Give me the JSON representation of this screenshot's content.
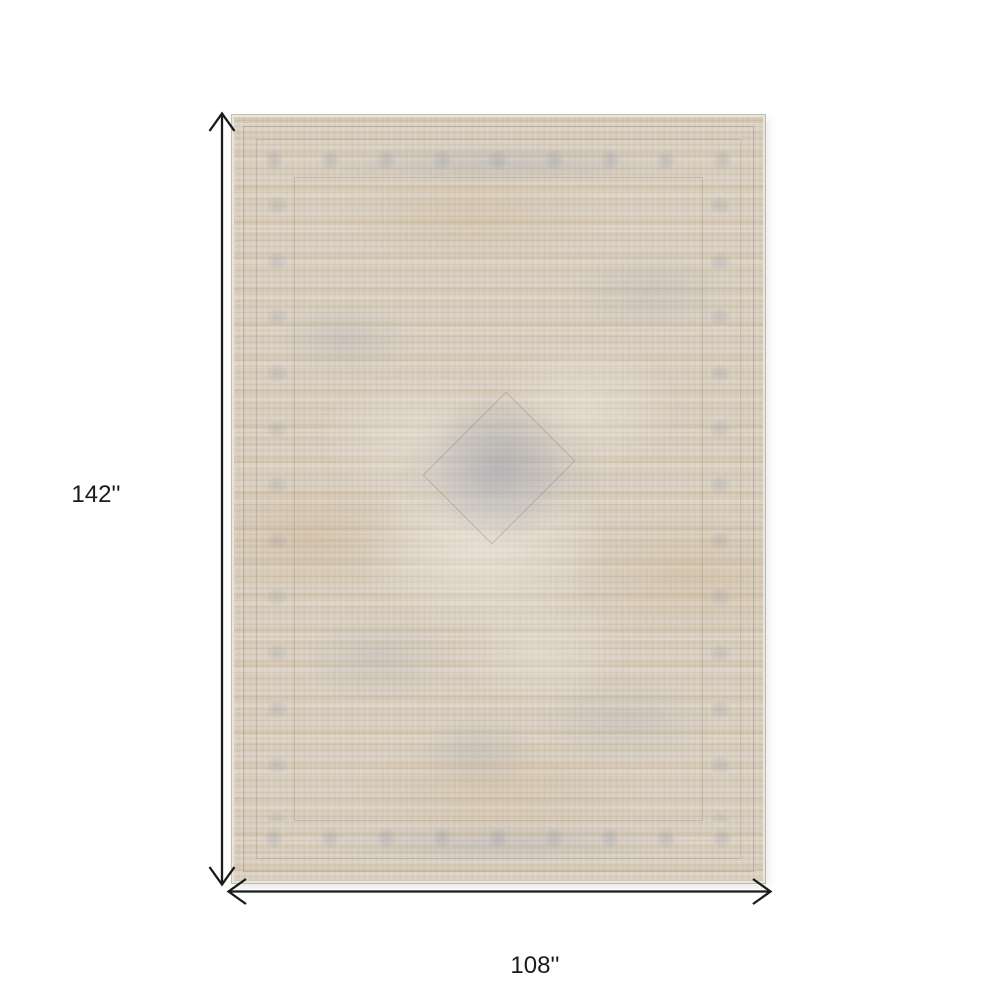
{
  "page": {
    "background_color": "#ffffff"
  },
  "product_image": {
    "alt": "Faded beige and gray-blue distressed oriental area rug shown flat",
    "colors": {
      "base": "#d8cfc1",
      "cream_highlight": "#f2ede4",
      "tan_stripe": "#c5a67c",
      "blue_gray_accent": "#9aa0b0",
      "edge_binding": "#eae5db"
    }
  },
  "dimensions": {
    "arrow_color": "#1b1b1b",
    "height_label": "142''",
    "width_label": "108''"
  }
}
